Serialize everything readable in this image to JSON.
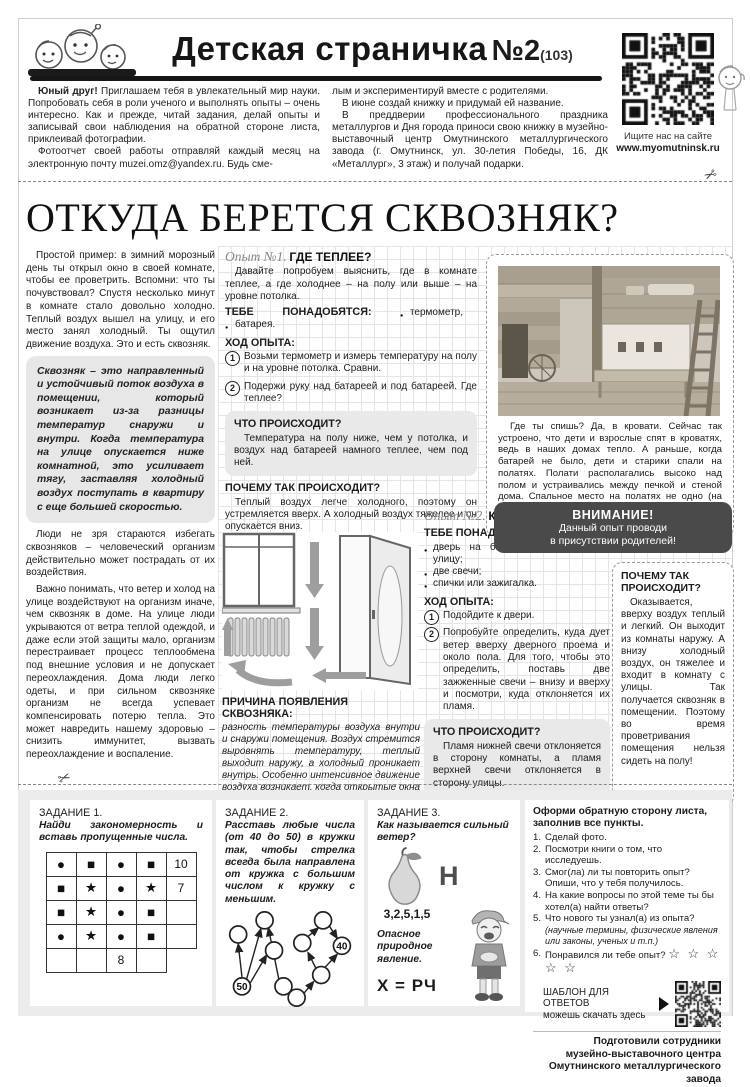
{
  "icons": {
    "scissors": "✂",
    "stars": "☆ ☆ ☆ ☆ ☆"
  },
  "header": {
    "title": "Детская страничка",
    "issue_no": "№2",
    "issue_total": "(103)",
    "qr_caption_1": "Ищите нас на сайте",
    "qr_caption_2": "www.myomutninsk.ru",
    "intro": {
      "p1_lead": "Юный друг!",
      "p1_rest": " Приглашаем тебя в увлекательный мир науки. Попробовать себя в роли ученого и выполнять опыты – очень интересно. Как и прежде, читай задания, делай опыты и записывай свои наблюдения на обратной стороне листа, приклеивай фотографии.",
      "p2": "Фотоотчет своей работы отправляй каждый месяц на электронную почту muzei.omz@yandex.ru. Будь сме-",
      "p3": "лым и экспериментируй вместе с родителями.",
      "p4": "В июне создай книжку и придумай ей название.",
      "p5": "В преддверии профессионального праздника металлургов и Дня города приноси свою книжку в музейно-выставочный центр Омутнинского металлургического завода (г. Омутнинск, ул. 30-летия Победы, 16, ДК «Металлург», 3 этаж) и получай подарки."
    }
  },
  "article": {
    "headline": "ОТКУДА БЕРЕТСЯ СКВОЗНЯК?",
    "p1": "Простой пример: в зимний морозный день ты открыл окно в своей комнате, чтобы ее проветрить. Вспомни: что ты почувствовал? Спустя несколько минут в комнате стало довольно холодно. Теплый воздух вышел на улицу, и его место занял холодный. Ты ощутил движение воздуха. Это и есть сквозняк.",
    "definition": "Сквозняк – это направленный и устойчивый поток воздуха в помещении, который возникает из-за разницы температур снаружи и внутри. Когда температура на улице опускается ниже комнатной, это усиливает тягу, заставляя холодный воздух поступать в квартиру с еще большей скоростью.",
    "p2": "Люди не зря стараются избегать сквозняков – человеческий организм действительно может пострадать от их воздействия.",
    "p3": "Важно понимать, что ветер и холод на улице воздействуют на организм иначе, чем сквозняк в доме. На улице люди укрываются от ветра теплой одеждой, и даже если этой защиты мало, организм перестраивает процесс теплообмена под внешние условия и не допускает переохлаждения. Дома люди легко одеты, и при сильном сквозняке организм не всегда успевает компенсировать потерю тепла. Это может навредить нашему здоровью – снизить иммунитет, вызвать переохлаждение и воспаление.",
    "cause_title": "ПРИЧИНА ПОЯВЛЕНИЯ СКВОЗНЯКА:",
    "cause_text": "разность температуры воздуха внутри и снаружи помещения. Воздух стремится выровнять температуру, теплый выходит наружу, а холодный проникает внутрь. Особенно интенсивное движение воздуха возникает, когда открытые окна или двери находятся в противоположных сторонах комнаты.",
    "photo_caption": "Где ты спишь? Да, в кровати. Сейчас так устроено, что дети и взрослые спят в кроватях, ведь в наших домах тепло. А раньше, когда батарей не было, дети и старики спали на полатях. Полати располагались высоко над полом и устраивались между печкой и стеной дома. Спальное место на полатях не одно (на них спали несколько человек). Там даже зимой было тепло, ведь полати находились вверху, где теплый воздух."
  },
  "exp1": {
    "label": "Опыт №1.",
    "title": "ГДЕ ТЕПЛЕЕ?",
    "intro": "Давайте попробуем выяснить, где в комнате теплее, а где холоднее – на полу или выше – на уровне потолка.",
    "need_label": "ТЕБЕ ПОНАДОБЯТСЯ:",
    "need_items": [
      "термометр,",
      "батарея."
    ],
    "steps_label": "ХОД ОПЫТА:",
    "steps": [
      {
        "n": "1",
        "t": "Возьми термометр и измерь температуру на полу и на уровне потолка. Сравни."
      },
      {
        "n": "2",
        "t": "Подержи руку над батареей и под батареей. Где теплее?"
      }
    ],
    "what_title": "ЧТО ПРОИСХОДИТ?",
    "what_text": "Температура на полу ниже, чем у потолка, и воздух над батареей намного теплее, чем под ней.",
    "why_title": "ПОЧЕМУ ТАК ПРОИСХОДИТ?",
    "why_text": "Теплый воздух легче холодного, поэтому он устремляется вверх. А холодный воздух тяжелее и он опускается вниз."
  },
  "exp2": {
    "label": "Опыт №2.",
    "title": "КУДА ДУЕТ ВЕТЕР?",
    "need_label": "ТЕБЕ ПОНАДОБЯТСЯ:",
    "need_items": [
      "дверь на балкон, в подъезд, на улицу;",
      "две свечи;",
      "спички или зажигалка."
    ],
    "steps_label": "ХОД ОПЫТА:",
    "steps": [
      {
        "n": "1",
        "t": "Подойдите к двери."
      },
      {
        "n": "2",
        "t": "Попробуйте определить, куда дует ветер вверху дверного проема и около пола. Для того, чтобы это определить, поставь две зажженные свечи – внизу и вверху и посмотри, куда отклоняется их пламя."
      }
    ],
    "what_title": "ЧТО ПРОИСХОДИТ?",
    "what_text": "Пламя нижней свечи отклоняется в сторону комнаты, а пламя верхней свечи отклоняется в сторону улицы.",
    "attention_title": "ВНИМАНИЕ!",
    "attention_text": "Данный опыт проводи\nв присутствии родителей!",
    "why_title": "ПОЧЕМУ ТАК ПРОИСХОДИТ?",
    "why_text": "Оказывается, вверху воздух теплый и легкий. Он выходит из комнаты наружу. А внизу холодный воздух, он тяжелее и входит в комнату с улицы. Так получается сквозняк в помещении. Поэтому во время проветривания помещения нельзя сидеть на полу!"
  },
  "tasks": {
    "t1": {
      "label": "ЗАДАНИЕ 1.",
      "text": "Найди закономерность и вставь пропущенные числа.",
      "grid": [
        [
          "●",
          "■",
          "●",
          "■",
          "10"
        ],
        [
          "■",
          "★",
          "●",
          "★",
          "7"
        ],
        [
          "■",
          "★",
          "●",
          "■",
          ""
        ],
        [
          "●",
          "★",
          "●",
          "■",
          ""
        ],
        [
          "",
          "",
          "8",
          "",
          ""
        ]
      ]
    },
    "t2": {
      "label": "ЗАДАНИЕ 2.",
      "text": "Расставь любые числа (от 40 до 50) в кружки так, чтобы стрелка всегда была направлена от кружка с большим числом к кружку с меньшим.",
      "node_big": "50",
      "node_small": "40"
    },
    "t3": {
      "label": "ЗАДАНИЕ 3.",
      "question": "Как называется сильный ветер?",
      "rebus_letter": "Н",
      "rebus_numbers": "3,2,5,1,5",
      "hint": "Опасное природное явление.",
      "formula": "Х = РЧ"
    },
    "checklist": {
      "title": "Оформи обратную сторону листа,\nзаполнив все пункты.",
      "items": [
        {
          "n": "1.",
          "t": "Сделай фото."
        },
        {
          "n": "2.",
          "t": "Посмотри книги о том, что исследуешь."
        },
        {
          "n": "3.",
          "t": "Смог(ла) ли ты повторить опыт?\nОпиши, что у тебя получилось."
        },
        {
          "n": "4.",
          "t": "На какие вопросы по этой теме ты бы хотел(а) найти ответы?"
        },
        {
          "n": "5.",
          "t": "Что нового ты узнал(а) из опыта?",
          "note": "(научные термины, физические явления или законы, ученых и т.п.)"
        },
        {
          "n": "6.",
          "t": "Понравился ли тебе опыт?"
        }
      ],
      "template_l1": "ШАБЛОН ДЛЯ ОТВЕТОВ",
      "template_l2": "можешь скачать здесь",
      "credits": [
        "Подготовили сотрудники",
        "музейно-выставочного центра",
        "Омутнинского металлургического завода"
      ]
    }
  }
}
